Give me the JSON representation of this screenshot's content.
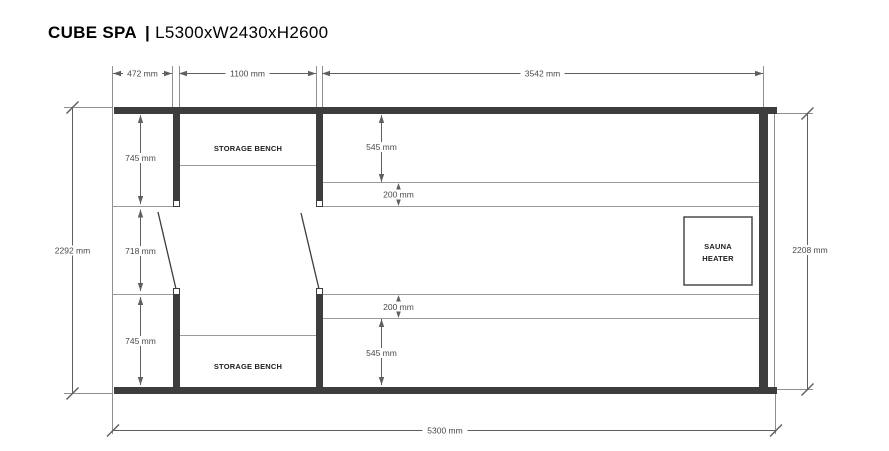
{
  "title": {
    "product": "CUBE SPA",
    "separator": "|",
    "size_code": "L5300xW2430xH2600"
  },
  "plan": {
    "labels": {
      "storage_bench_top": "STORAGE BENCH",
      "storage_bench_bottom": "STORAGE BENCH",
      "sauna_heater_line1": "SAUNA",
      "sauna_heater_line2": "HEATER"
    },
    "dimensions": {
      "top": [
        "472 mm",
        "1100 mm",
        "3542 mm"
      ],
      "left_overall": "2292 mm",
      "left_inner": [
        "745 mm",
        "718 mm",
        "745 mm"
      ],
      "right_overall": "2208 mm",
      "bottom_overall": "5300 mm",
      "bench_top_section": [
        "545 mm",
        "200 mm"
      ],
      "bench_bottom_section": [
        "200 mm",
        "545 mm"
      ]
    },
    "colors": {
      "wall": "#3d3d3d",
      "line": "#8f8f8f",
      "bench": "#9a9a9a",
      "dim": "#5f5f5f",
      "dim_text": "#4a4a4a",
      "label_text": "#1d1d1d",
      "background": "#ffffff"
    }
  }
}
